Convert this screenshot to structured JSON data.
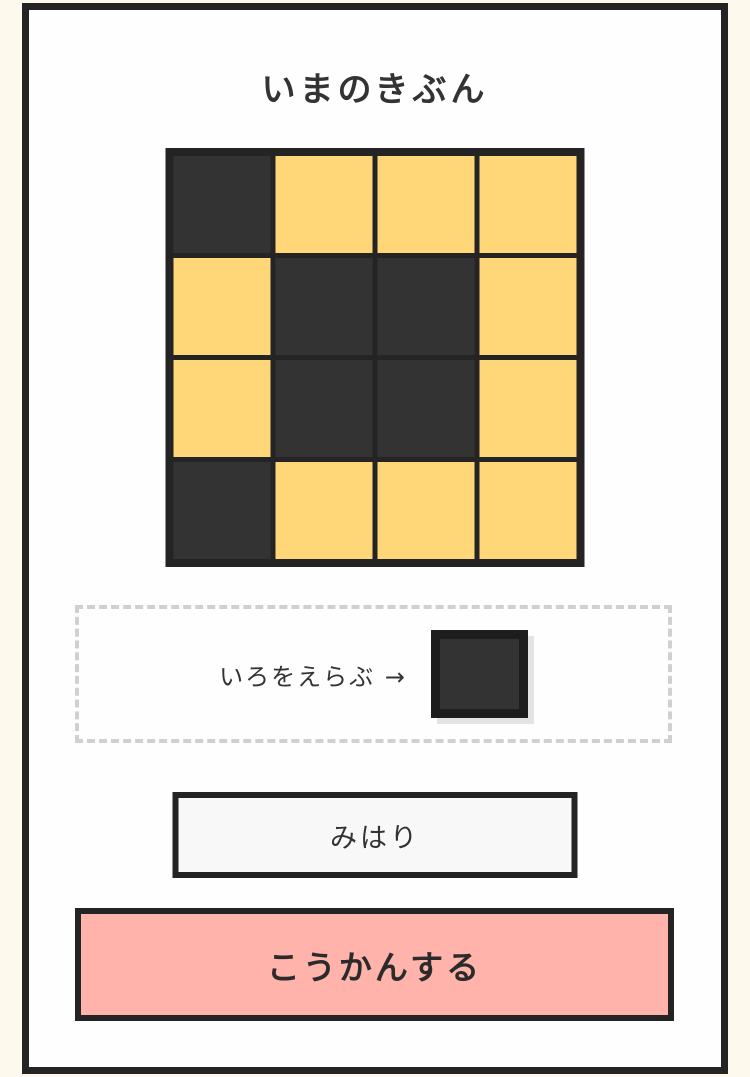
{
  "theme": {
    "page_background": "#fdf9ec",
    "card_background": "#fefefe",
    "border_color": "#242424",
    "text_color": "#333333",
    "dash_color": "#d0d0d0"
  },
  "title": "いまのきぶん",
  "grid": {
    "rows": 4,
    "cols": 4,
    "colors": {
      "dark": "#333333",
      "yellow": "#ffd678"
    },
    "cells": [
      [
        "dark",
        "yellow",
        "yellow",
        "yellow"
      ],
      [
        "yellow",
        "dark",
        "dark",
        "yellow"
      ],
      [
        "yellow",
        "dark",
        "dark",
        "yellow"
      ],
      [
        "dark",
        "yellow",
        "yellow",
        "yellow"
      ]
    ]
  },
  "color_picker": {
    "label": "いろをえらぶ",
    "arrow": "→",
    "selected_color": "#333333",
    "selected_border": "#1d1d1d"
  },
  "buttons": {
    "watch_label": "みはり",
    "watch_background": "#f8f8f8",
    "exchange_label": "こうかんする",
    "exchange_background": "#ffb3ab"
  }
}
